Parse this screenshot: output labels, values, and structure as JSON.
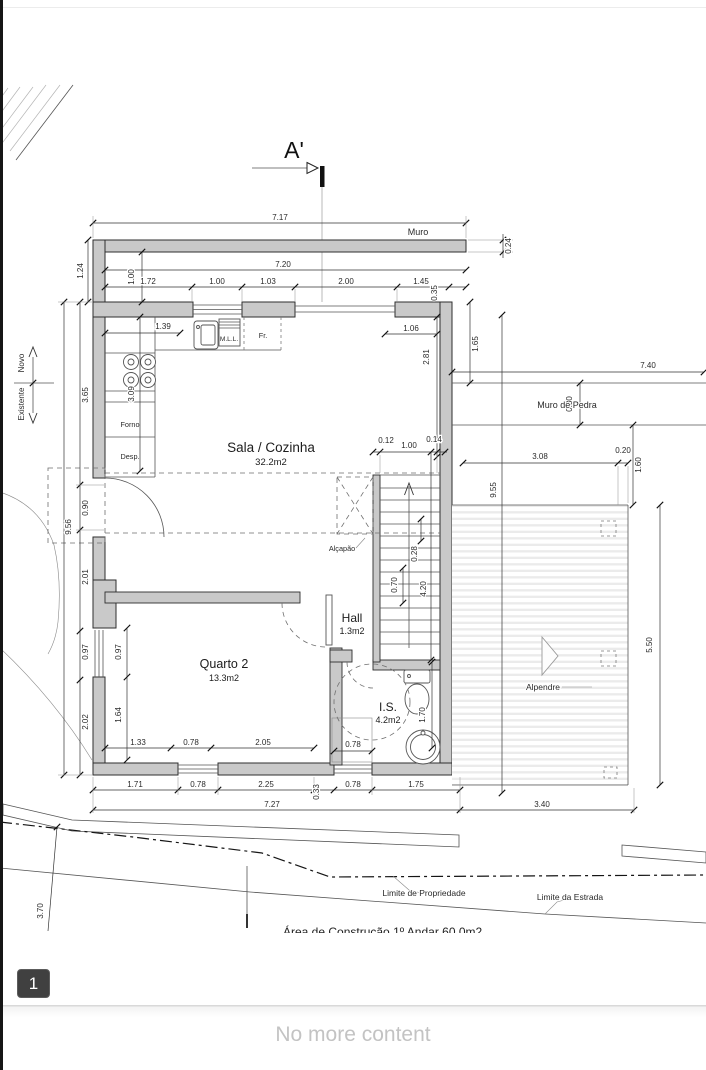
{
  "viewer": {
    "page_badge": "1",
    "end_message": "No more content",
    "colors": {
      "badge_bg": "#404040",
      "wall_fill": "#c9c9c9",
      "end_text": "#c3c3c3"
    }
  },
  "plan": {
    "section_label": "A'",
    "rooms": {
      "sala_name": "Sala / Cozinha",
      "sala_area": "32.2m2",
      "quarto2_name": "Quarto 2",
      "quarto2_area": "13.3m2",
      "hall_name": "Hall",
      "hall_area": "1.3m2",
      "is_name": "I.S.",
      "is_area": "4.2m2",
      "alpendre_name": "Alpendre"
    },
    "labels": {
      "muro": "Muro",
      "muro_de_pedra": "Muro de Pedra",
      "alcapao": "Alçapão",
      "forno": "Forno",
      "despensa": "Desp.",
      "dishwasher": "M.L.L.",
      "fridge": "Fr.",
      "novo": "Novo",
      "existente": "Existente",
      "limite_propriedade": "Limite de Propriedade",
      "limite_estrada": "Limite da Estrada",
      "area_construcao": "Área de Construção   1º Andar    60.0m2"
    },
    "dims": {
      "h717": "7.17",
      "h720": "7.20",
      "h172": "1.72",
      "h100a": "1.00",
      "h103": "1.03",
      "h200": "2.00",
      "h145": "1.45",
      "h139": "1.39",
      "h106": "1.06",
      "h740": "7.40",
      "h308": "3.08",
      "h020": "0.20",
      "h012": "0.12",
      "h100b": "1.00",
      "h014": "0.14",
      "h133": "1.33",
      "h078a": "0.78",
      "h205": "2.05",
      "h078b": "0.78",
      "h171": "1.71",
      "h078c": "0.78",
      "h225": "2.25",
      "h078d": "0.78",
      "h175": "1.75",
      "h727": "7.27",
      "h340": "3.40",
      "v024": "0.24",
      "v124": "1.24",
      "v100": "1.00",
      "v035": "0.35",
      "v165": "1.65",
      "v281": "2.81",
      "v365": "3.65",
      "v309": "3.09",
      "v956": "9.56",
      "v090": "0.90",
      "v201": "2.01",
      "v097a": "0.97",
      "v097b": "0.97",
      "v202": "2.02",
      "v164": "1.64",
      "v955": "9.55",
      "v028": "0.28",
      "v070": "0.70",
      "v420": "4.20",
      "v170": "1.70",
      "v080": "0.80",
      "v160": "1.60",
      "v550": "5.50",
      "v033": "0.33",
      "v370": "3.70"
    }
  }
}
